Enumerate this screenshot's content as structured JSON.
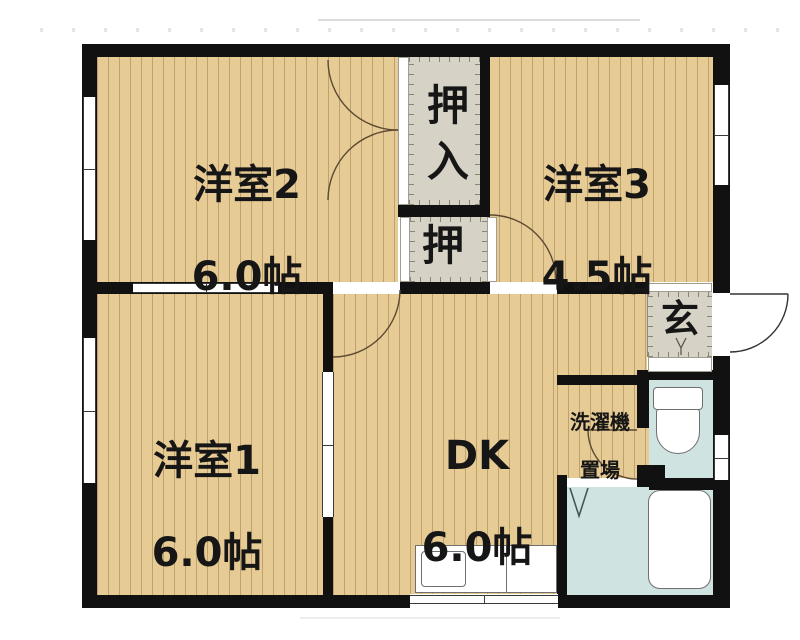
{
  "rooms": {
    "room2": {
      "name": "洋室2",
      "size": "6.0帖"
    },
    "room3": {
      "name": "洋室3",
      "size": "4.5帖"
    },
    "room1": {
      "name": "洋室1",
      "size": "6.0帖"
    },
    "dk": {
      "name": "DK",
      "size": "6.0帖"
    },
    "closet_large": {
      "name": "押入"
    },
    "closet_small": {
      "name": "押"
    },
    "entrance": {
      "name": "玄"
    },
    "laundry": {
      "name": "洗濯機置場",
      "line1": "洗濯機",
      "line2": "置場"
    }
  },
  "colors": {
    "wall": "#111111",
    "wood_floor": "#e7cb94",
    "closet_gray": "#d6d2c5",
    "wet_area_blue": "#cfe3e0"
  }
}
